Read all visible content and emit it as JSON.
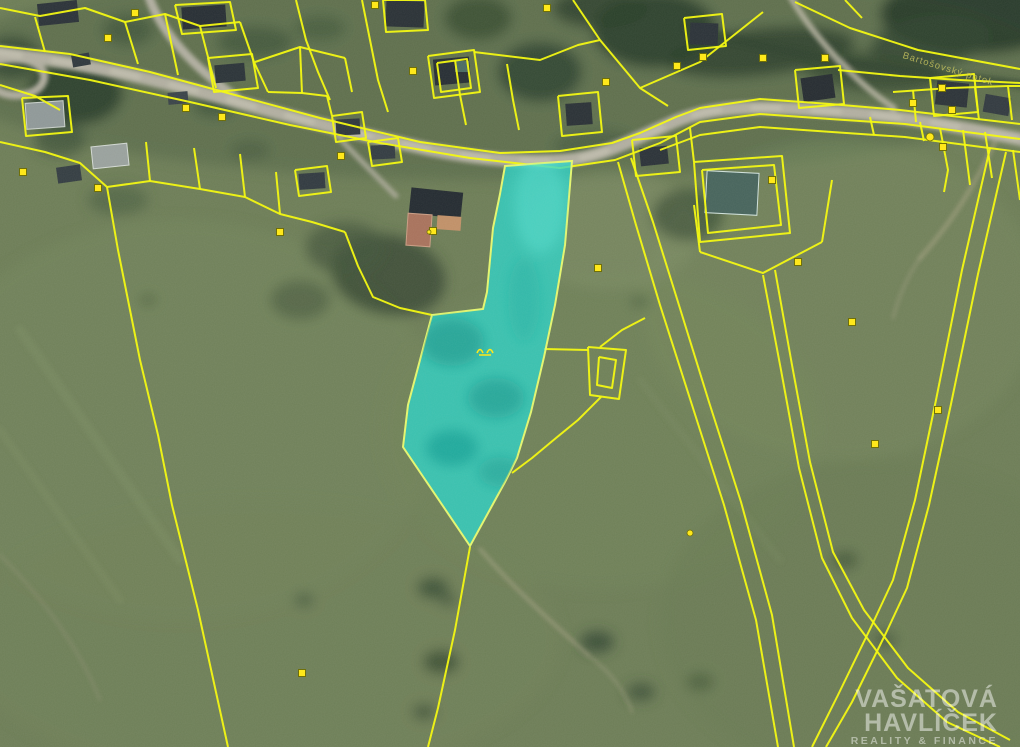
{
  "image": {
    "type_label": "cadastral-aerial-map",
    "watermark": {
      "line1": "VAŠATOVÁ",
      "line2": "HAVLÍČEK",
      "line3": "REALITY & FINANCE",
      "color": "#ffffff"
    },
    "stream_label": "Bartošovský potok"
  },
  "map": {
    "colors": {
      "base_meadow": "#6d7d57",
      "parcel": "#f3f80c",
      "road": "#b1aea0",
      "marker_fill": "#ffe713",
      "marker_stroke": "#6b6b00",
      "highlight_fill": "#2bd4c8",
      "highlight_stroke": "#e3f56e"
    },
    "terrain": [
      [
        500,
        70,
        560,
        110,
        "#5c6f4e",
        0.9,
        0
      ],
      [
        180,
        420,
        260,
        200,
        "#73855c",
        0.55,
        0
      ],
      [
        260,
        640,
        300,
        140,
        "#6f8158",
        0.6,
        0
      ],
      [
        600,
        430,
        220,
        160,
        "#718359",
        0.5,
        0
      ],
      [
        840,
        300,
        200,
        160,
        "#76885e",
        0.45,
        0
      ],
      [
        880,
        620,
        220,
        160,
        "#687951",
        0.5,
        0
      ],
      [
        610,
        230,
        90,
        60,
        "#7f8e66",
        0.5,
        0
      ],
      [
        975,
        14,
        95,
        40,
        "#283a2a",
        0.95,
        0
      ],
      [
        930,
        42,
        60,
        26,
        "#31452f",
        0.8,
        -8
      ],
      [
        760,
        52,
        95,
        24,
        "#2e422e",
        0.85,
        -6
      ],
      [
        872,
        72,
        70,
        20,
        "#33462f",
        0.8,
        5
      ],
      [
        655,
        30,
        62,
        38,
        "#2b3e2c",
        0.9,
        0
      ],
      [
        540,
        72,
        42,
        30,
        "#304430",
        0.85,
        0
      ],
      [
        478,
        18,
        34,
        22,
        "#35492f",
        0.75,
        0
      ],
      [
        600,
        8,
        48,
        20,
        "#2d402c",
        0.8,
        0
      ],
      [
        75,
        93,
        48,
        32,
        "#293b2a",
        0.85,
        0
      ],
      [
        12,
        58,
        30,
        22,
        "#31452f",
        0.8,
        0
      ],
      [
        128,
        30,
        26,
        16,
        "#3a4e36",
        0.6,
        0
      ],
      [
        255,
        42,
        38,
        16,
        "#3a4e36",
        0.65,
        0
      ],
      [
        320,
        28,
        26,
        13,
        "#40543a",
        0.55,
        0
      ],
      [
        388,
        275,
        58,
        40,
        "#374932",
        0.8,
        12
      ],
      [
        345,
        248,
        40,
        26,
        "#43563b",
        0.7,
        0
      ],
      [
        300,
        300,
        30,
        20,
        "#46593d",
        0.6,
        0
      ],
      [
        688,
        215,
        36,
        26,
        "#3c5038",
        0.7,
        0
      ],
      [
        592,
        143,
        40,
        13,
        "#42553d",
        0.6,
        -5
      ],
      [
        118,
        200,
        30,
        15,
        "#4a5d40",
        0.6,
        0
      ],
      [
        60,
        140,
        26,
        16,
        "#3c4f38",
        0.7,
        0
      ],
      [
        433,
        588,
        16,
        11,
        "#3b4e37",
        0.8,
        0
      ],
      [
        441,
        662,
        18,
        12,
        "#384b34",
        0.8,
        0
      ],
      [
        424,
        712,
        12,
        8,
        "#3c4f38",
        0.75,
        0
      ],
      [
        448,
        600,
        10,
        7,
        "#445741",
        0.7,
        0
      ],
      [
        304,
        600,
        10,
        7,
        "#45583e",
        0.7,
        0
      ],
      [
        148,
        300,
        9,
        6,
        "#4a5d40",
        0.6,
        0
      ],
      [
        640,
        302,
        10,
        6,
        "#4a5d40",
        0.6,
        0
      ],
      [
        597,
        642,
        17,
        11,
        "#364933",
        0.8,
        0
      ],
      [
        641,
        692,
        14,
        9,
        "#3a4d36",
        0.75,
        0
      ],
      [
        845,
        560,
        13,
        9,
        "#3d5039",
        0.7,
        0
      ],
      [
        885,
        640,
        12,
        8,
        "#41543c",
        0.7,
        0
      ],
      [
        700,
        682,
        14,
        9,
        "#43563b",
        0.6,
        0
      ],
      [
        250,
        150,
        20,
        10,
        "#46593d",
        0.6,
        0
      ],
      [
        215,
        105,
        22,
        12,
        "#3b4e37",
        0.7,
        0
      ]
    ],
    "roads": [
      {
        "name": "mowing-stripe",
        "d": "M 20,330 L 180,560",
        "c": "#8a9b6d",
        "w": 10,
        "o": 0.2
      },
      {
        "name": "mowing-stripe",
        "d": "M 0,430 L 120,600",
        "c": "#8a9b6d",
        "w": 8,
        "o": 0.18
      },
      {
        "name": "mowing-stripe",
        "d": "M 640,380 L 780,560",
        "c": "#8a9b6d",
        "w": 8,
        "o": 0.12
      },
      {
        "name": "stream-band",
        "d": "M 688,28 C 750,44 820,60 900,70 C 952,76 992,80 1024,85",
        "c": "#2c3f2d",
        "w": 9,
        "o": 0.6
      },
      {
        "name": "field-trail",
        "d": "M 480,549 C 515,590 555,625 588,655",
        "c": "#b5ac90",
        "w": 3,
        "o": 0.55
      },
      {
        "name": "field-trail",
        "d": "M 588,655 C 610,672 625,690 632,712",
        "c": "#b5ac90",
        "w": 2.5,
        "o": 0.4
      },
      {
        "name": "field-trail",
        "d": "M 995,142 C 975,185 952,222 920,258",
        "c": "#b3aa8e",
        "w": 4,
        "o": 0.5
      },
      {
        "name": "field-trail",
        "d": "M 920,258 C 905,280 898,300 893,318",
        "c": "#b3aa8e",
        "w": 3,
        "o": 0.35
      },
      {
        "name": "field-trail",
        "d": "M 0,555 C 45,600 80,650 100,700",
        "c": "#a9a088",
        "w": 2.5,
        "o": 0.3
      },
      {
        "name": "hill-trail",
        "d": "M 790,-4 C 812,34 852,80 894,108",
        "c": "#b8b5a3",
        "w": 6,
        "o": 0.85
      },
      {
        "name": "loop-road",
        "d": "M -6,62 C 26,53 50,66 43,82 C 36,98 6,99 -6,88",
        "c": "#aeab9d",
        "w": 8,
        "o": 1
      },
      {
        "name": "branch-road",
        "d": "M 148,-6 C 158,26 186,62 236,97",
        "c": "#b1aea0",
        "w": 9,
        "o": 1
      },
      {
        "name": "main-road",
        "d": "M -6,52 C 80,62 150,78 230,100 C 310,122 365,136 432,150 C 482,160 532,163 566,160 C 602,157 632,140 676,121 C 720,103 772,107 842,112 C 902,116 962,127 1024,140",
        "c": "#b1aea0",
        "w": 13,
        "o": 1
      },
      {
        "name": "main-road-sheen",
        "d": "M -6,52 C 80,62 150,78 230,100 C 310,122 365,136 432,150 C 482,160 532,163 566,160 C 602,157 632,140 676,121 C 720,103 772,107 842,112 C 902,116 962,127 1024,140",
        "c": "#c6c3b3",
        "w": 6,
        "o": 0.6,
        "a": "26 34"
      },
      {
        "name": "driveway",
        "d": "M 332,130 C 352,152 372,172 396,196",
        "c": "#b1aea0",
        "w": 5,
        "o": 0.85
      }
    ],
    "parcel_lines": [
      "0,46 70,54 150,72 235,95 320,118 420,142 500,153 560,151 612,143 640,133 676,117 700,108 760,99 830,104 900,110 1020,124",
      "0,64 90,80 190,102 290,125 380,143 470,158 560,168 615,160 660,143 700,122 760,114 830,119 905,124 1020,139",
      "660,150 700,135 760,127 832,132 905,137 1020,152",
      "0,8 40,16 85,8 125,22 165,14 200,26 240,22",
      "35,17 45,52",
      "125,22 138,64",
      "165,14 178,75",
      "200,26 216,88",
      "240,22 254,62 268,92",
      "296,0 306,40 318,72 330,100",
      "362,0 370,40 378,80 388,112",
      "175,5 230,2 236,30 182,34 175,5",
      "383,0 425,0 428,30 386,32 383,0",
      "428,56 474,50 480,92 434,98 428,56",
      "437,63 467,59 471,88 441,92 437,63",
      "255,62 300,47 345,58",
      "300,47 302,93",
      "268,92 302,93 327,96",
      "327,96 332,116",
      "345,58 352,92",
      "474,52 540,60 578,45 600,40",
      "573,0 600,40 640,88 668,106",
      "640,88 700,62 763,12",
      "684,18 722,14 726,46 688,50 684,18",
      "795,70 840,66 844,104 799,108 795,70",
      "455,60 460,95 466,125",
      "507,64 513,100 519,130",
      "0,85 35,96 60,110",
      "22,98 68,96 72,132 26,136 22,98",
      "0,142 45,152 80,163 107,187",
      "107,187 150,181 200,189 245,197 280,214 312,222 345,232",
      "150,181 146,142",
      "200,189 194,148",
      "245,197 240,154",
      "280,214 276,172",
      "107,187 118,250 140,360 158,435 172,505 198,610 228,747",
      "345,232 358,266 373,297 400,308 432,315",
      "332,116 362,112 366,138 336,142 332,116",
      "368,142 398,138 402,162 372,166 368,142",
      "295,170 327,166 331,192 299,196 295,170",
      "558,96 598,92 602,132 562,136 558,96",
      "632,140 676,136 680,172 636,176 632,140",
      "208,58 252,54 258,88 214,92 208,58",
      "930,78 974,74 978,112 934,116 930,78",
      "544,349 588,350",
      "588,347 626,350 619,399 590,395 588,347",
      "599,357 616,360 612,388 597,385 599,357",
      "600,347 622,330 645,318",
      "601,397 578,420 556,438 532,458 512,473",
      "470,547 455,630 438,708 428,747",
      "618,162 636,225 660,305 692,405 724,505 756,620 778,747",
      "631,158 653,222 678,302 709,402 741,502 772,615 794,747",
      "700,252 763,273 822,242",
      "700,252 694,205",
      "822,242 832,180",
      "694,162 782,156 790,233 700,242 694,162",
      "702,170 774,165 781,225 708,233 702,170",
      "690,128 694,162",
      "763,275 781,370 799,468 822,558 852,618 897,678 947,722 1000,747",
      "775,270 792,365 810,462 833,552 864,610 908,668 958,712 1010,740",
      "990,148 962,270 936,400 915,500 893,580 872,625 838,695 812,747",
      "1006,152 978,274 951,404 929,505 907,588 886,633 852,702 826,747",
      "1013,150 1020,200",
      "893,92 950,88 1008,86 1020,86",
      "913,90 916,122",
      "975,88 979,120",
      "1008,86 1012,120",
      "838,70 900,76 960,80 1020,83",
      "795,2 850,28 918,50 1020,69",
      "845,0 862,18",
      "940,128 948,170 944,192",
      "985,132 992,178",
      "963,130 970,185",
      "870,117 874,135",
      "920,122 924,141"
    ],
    "houses": [
      [
        38,
        2,
        40,
        22,
        -6,
        "#2b3238"
      ],
      [
        182,
        6,
        44,
        22,
        -4,
        "#272e34"
      ],
      [
        386,
        1,
        38,
        26,
        2,
        "#2a3136"
      ],
      [
        434,
        58,
        36,
        26,
        -5,
        "#272e34"
      ],
      [
        690,
        23,
        28,
        22,
        2,
        "#2b3238"
      ],
      [
        802,
        76,
        32,
        24,
        -8,
        "#262c31"
      ],
      [
        936,
        82,
        32,
        24,
        6,
        "#2c3338"
      ],
      [
        984,
        96,
        26,
        18,
        10,
        "#323a40"
      ],
      [
        26,
        102,
        38,
        26,
        -4,
        "#8f9898",
        "#c8cfc9"
      ],
      [
        92,
        145,
        36,
        22,
        -6,
        "#99a19d",
        "#d2d8d2"
      ],
      [
        215,
        64,
        30,
        18,
        -5,
        "#2b3338"
      ],
      [
        299,
        173,
        26,
        16,
        -4,
        "#313a40"
      ],
      [
        336,
        119,
        24,
        16,
        -3,
        "#2e363c"
      ],
      [
        371,
        145,
        24,
        14,
        -3,
        "#333c42"
      ],
      [
        566,
        103,
        26,
        22,
        -4,
        "#2a3136"
      ],
      [
        640,
        147,
        28,
        18,
        -6,
        "#2b3238"
      ],
      [
        706,
        172,
        52,
        42,
        3,
        "#47645c",
        "#cfe0da"
      ],
      [
        410,
        190,
        52,
        26,
        6,
        "#242b31"
      ],
      [
        407,
        214,
        24,
        32,
        4,
        "#a8725c",
        "#c99c83"
      ],
      [
        437,
        216,
        24,
        14,
        4,
        "#c09068"
      ],
      [
        455,
        61,
        14,
        11,
        0,
        "#4a6a62"
      ],
      [
        57,
        166,
        24,
        16,
        -8,
        "#343d42"
      ],
      [
        72,
        54,
        18,
        12,
        -10,
        "#2f383d"
      ],
      [
        168,
        92,
        20,
        12,
        -5,
        "#3a4348"
      ]
    ],
    "markers": [
      [
        23,
        172
      ],
      [
        98,
        188
      ],
      [
        135,
        13
      ],
      [
        222,
        117
      ],
      [
        280,
        232
      ],
      [
        375,
        5
      ],
      [
        413,
        71
      ],
      [
        433,
        231
      ],
      [
        598,
        268
      ],
      [
        606,
        82
      ],
      [
        677,
        66
      ],
      [
        703,
        57
      ],
      [
        763,
        58
      ],
      [
        772,
        180
      ],
      [
        825,
        58
      ],
      [
        852,
        322
      ],
      [
        875,
        444
      ],
      [
        938,
        410
      ],
      [
        798,
        262
      ],
      [
        302,
        673
      ],
      [
        942,
        88
      ],
      [
        913,
        103
      ],
      [
        952,
        110
      ],
      [
        943,
        147
      ],
      [
        108,
        38
      ],
      [
        547,
        8
      ],
      [
        186,
        108
      ],
      [
        341,
        156
      ]
    ],
    "dots": [
      [
        930,
        137,
        4
      ],
      [
        690,
        533,
        3
      ],
      [
        429,
        232,
        2
      ]
    ],
    "highlight": {
      "points": "505,166 572,161 565,245 555,305 544,357 531,412 517,458 505,482 470,546 403,447 408,405 420,360 432,315 483,309 487,292 493,228 500,194",
      "fill": "#2bd4c8",
      "stroke": "#e3f56e",
      "opacity": 0.78,
      "shade": [
        [
          452,
          342,
          32,
          24,
          "#0e8c84",
          0.5
        ],
        [
          496,
          398,
          28,
          20,
          "#119087",
          0.5
        ],
        [
          452,
          448,
          26,
          18,
          "#0e8c84",
          0.45
        ],
        [
          500,
          472,
          22,
          15,
          "#119087",
          0.4
        ],
        [
          524,
          300,
          16,
          42,
          "#18a79d",
          0.3
        ],
        [
          540,
          205,
          26,
          48,
          "#62e8da",
          0.35
        ]
      ]
    },
    "meadow_symbol": {
      "x": 484,
      "y": 350
    }
  }
}
